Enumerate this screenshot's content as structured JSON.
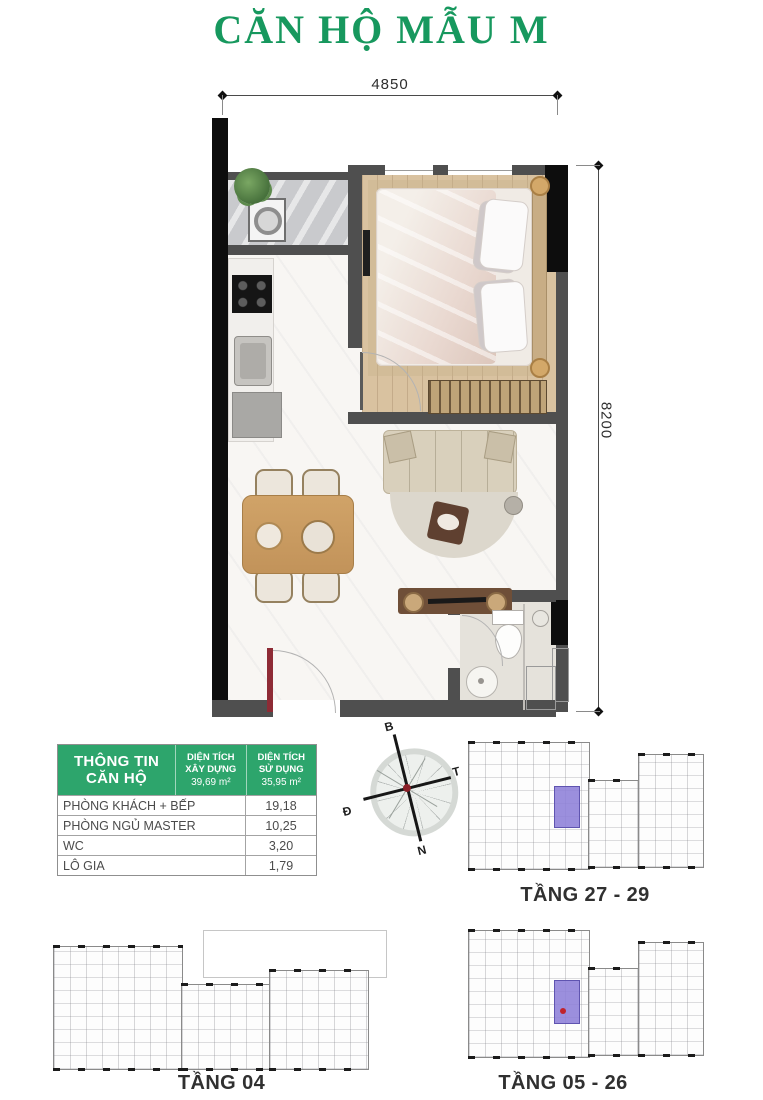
{
  "title": "CĂN HỘ MẪU M",
  "dimensions": {
    "width": "4850",
    "height": "8200"
  },
  "info_table": {
    "title": "THÔNG TIN\nCĂN HỘ",
    "col_built": {
      "label": "DIỆN TÍCH\nXÂY DỰNG",
      "value": "39,69 m²"
    },
    "col_usable": {
      "label": "DIỆN TÍCH\nSỬ DỤNG",
      "value": "35,95 m²"
    },
    "rows": [
      {
        "label": "PHÒNG KHÁCH + BẾP",
        "value": "19,18"
      },
      {
        "label": "PHÒNG NGỦ MASTER",
        "value": "10,25"
      },
      {
        "label": "WC",
        "value": "3,20"
      },
      {
        "label": "LÔ GIA",
        "value": "1,79"
      }
    ]
  },
  "compass": {
    "north": "B",
    "east": "Đ",
    "south": "N",
    "west": "T"
  },
  "floor_plates": [
    {
      "label": "TẦNG 27 - 29",
      "unit_highlighted": true,
      "unit_dot": false
    },
    {
      "label": "TẦNG 04",
      "unit_highlighted": false,
      "unit_dot": false
    },
    {
      "label": "TẦNG 05 - 26",
      "unit_highlighted": true,
      "unit_dot": true
    }
  ],
  "colors": {
    "title_green": "#17985e",
    "table_header_green": "#2da56c",
    "unit_highlight_purple": "#8d80d8",
    "entry_door_red": "#8e2b35"
  }
}
